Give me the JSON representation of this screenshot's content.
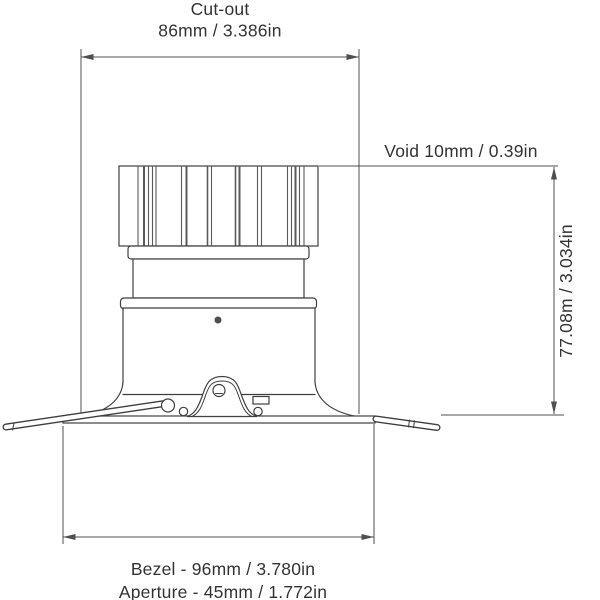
{
  "drawing_title": "Recessed downlight technical dimension drawing",
  "dimensions": {
    "cutout_label": "Cut-out",
    "cutout_value": "86mm / 3.386in",
    "void_label": "Void 10mm / 0.39in",
    "height_label": "77.08m / 3.034in",
    "bezel_label": "Bezel - 96mm / 3.780in",
    "aperture_label": "Aperture - 45mm / 1.772in"
  },
  "colors": {
    "background": "#ffffff",
    "outline": "#3f3f3f",
    "dimension_line": "#4f4f4f",
    "text": "#333333",
    "screw_dot": "#4e4e4e"
  }
}
